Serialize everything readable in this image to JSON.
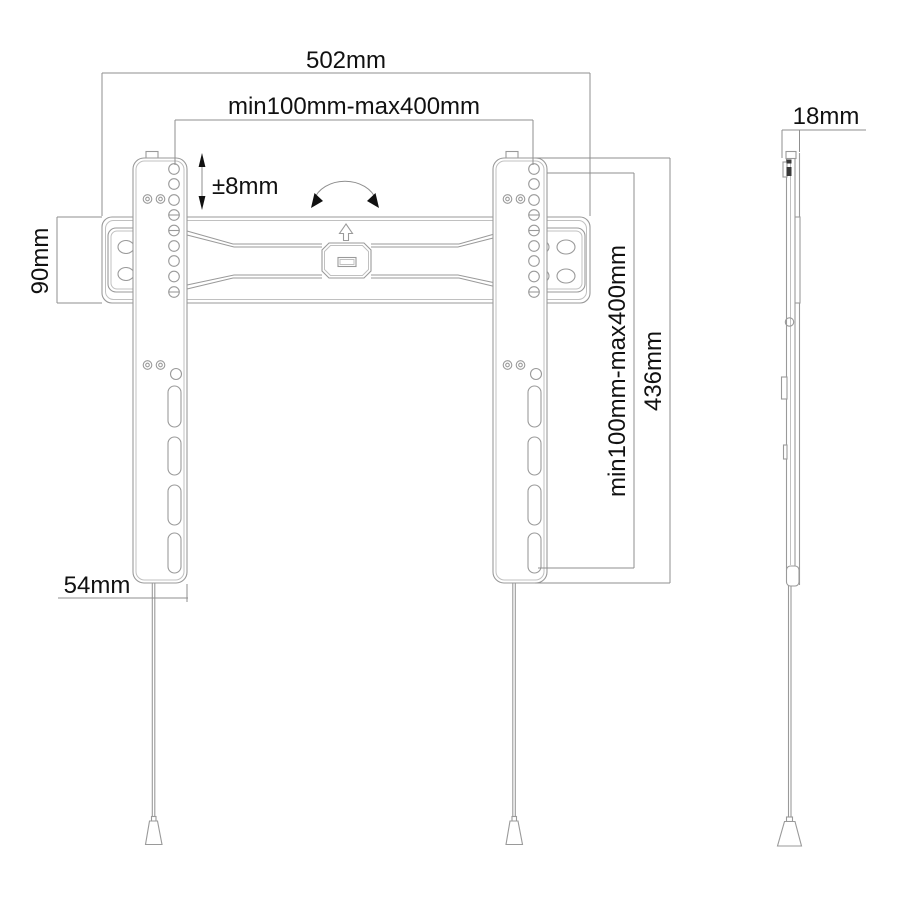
{
  "page": {
    "background": "#ffffff"
  },
  "drawing": {
    "type": "technical-line-drawing",
    "subject": "Flat TV wall mount - front view and side view with dimension callouts",
    "colors": {
      "product_line": "#9a9a9a",
      "dimension_line": "#8f8f8f",
      "text": "#111111",
      "arrow_fill": "#111111",
      "background": "#ffffff"
    },
    "dimensions": {
      "total_width": "502mm",
      "vesa_width_range": "min100mm-max400mm",
      "level_adjustment": "±8mm",
      "wall_plate_height": "90mm",
      "bracket_width": "54mm",
      "vesa_height_range": "min100mm-max400mm",
      "bracket_height": "436mm",
      "profile_depth": "18mm"
    }
  }
}
